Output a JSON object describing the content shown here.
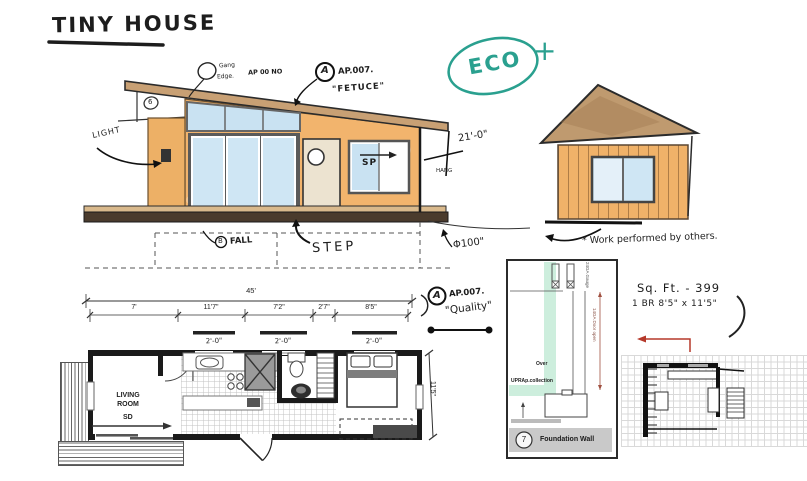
{
  "title": "TINY HOUSE",
  "eco": {
    "label": "ECO",
    "plus": "+"
  },
  "elevation_notes": {
    "edge_note_l1": "Gang",
    "edge_note_l2": "Edge.",
    "edge_note_l3": "AP 00 NO",
    "ap007_badge": "A",
    "ap007_ref": "AP.007.",
    "ap007_name": "\"FETUCE\"",
    "light": "LIGHT",
    "sp": "SP",
    "hang": "HANG",
    "dim_21": "21'-0\"",
    "step": "STEP",
    "fall_badge": "B",
    "fall": "FALL",
    "dim_phi": "Φ100\"",
    "roof_mark": "6"
  },
  "side_note": "* Work performed by others.",
  "quality_note": {
    "badge": "A",
    "ref": "AP.007.",
    "name": "\"Quality\""
  },
  "specs": {
    "sqft": "Sq. Ft. - 399",
    "bed": "1 BR 8'5\" x 11'5\""
  },
  "floor_plan": {
    "total_width": "45'",
    "segment_dims": [
      "7'",
      "11'7\"",
      "7'2\"",
      "2'7\"",
      "8'5\""
    ],
    "window_dims": [
      "2'-0\"",
      "2'-0\"",
      "2'-0\""
    ],
    "height_dim": "11'5\"",
    "living_room": "LIVING ROOM",
    "sliding_door": "SD"
  },
  "detail_panel": {
    "number": "7",
    "title": "Foundation Wall",
    "note_over": "Over",
    "note_collection": "UPRAp.collection",
    "gauge_note": "24GA Gauge",
    "door_note": "14GA Door open"
  },
  "colors": {
    "ink": "#222222",
    "wall": "#f2b46d",
    "roof": "#bf9a6f",
    "glass": "#c9e2f2",
    "teal": "#2aa08f",
    "red": "#b5382a",
    "green": "#cdeedd",
    "panel_gray": "#c9c9c9"
  }
}
